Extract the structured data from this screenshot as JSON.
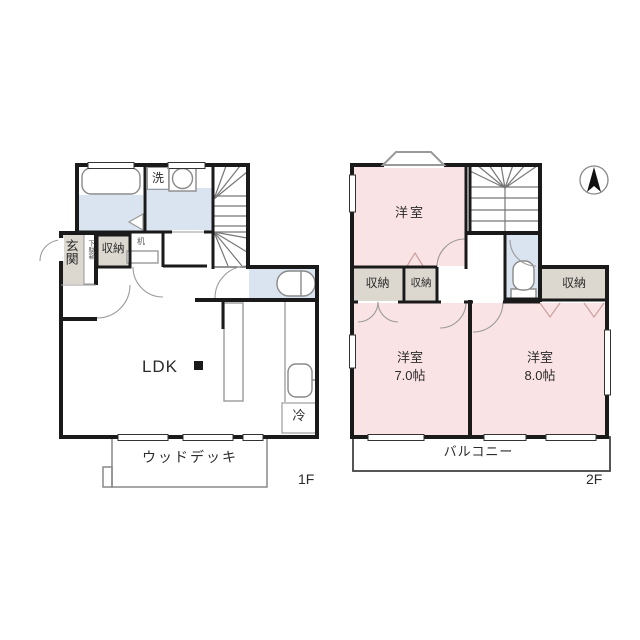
{
  "floor1": {
    "floor_label": "1F",
    "washroom_label": "洗",
    "entrance_label": "玄関",
    "shoe_cabinet_label": "下駄箱",
    "storage_label": "収納",
    "desk_label": "机",
    "ldk_label": "LDK",
    "fridge_label": "冷",
    "wood_deck_label": "ウッドデッキ"
  },
  "floor2": {
    "floor_label": "2F",
    "bedroom_top_label": "洋室",
    "storage_left_label": "収納",
    "storage_mid_label": "収納",
    "storage_right_label": "収納",
    "bedroom_left_label": "洋室",
    "bedroom_left_size": "7.0帖",
    "bedroom_right_label": "洋室",
    "bedroom_right_size": "8.0帖",
    "balcony_label": "バルコニー"
  },
  "colors": {
    "wet_area_blue": "#dae4f0",
    "bedroom_pink": "#fae3e4",
    "storage_grey": "#dcd8cf",
    "wall_black": "#1a1a1a"
  }
}
